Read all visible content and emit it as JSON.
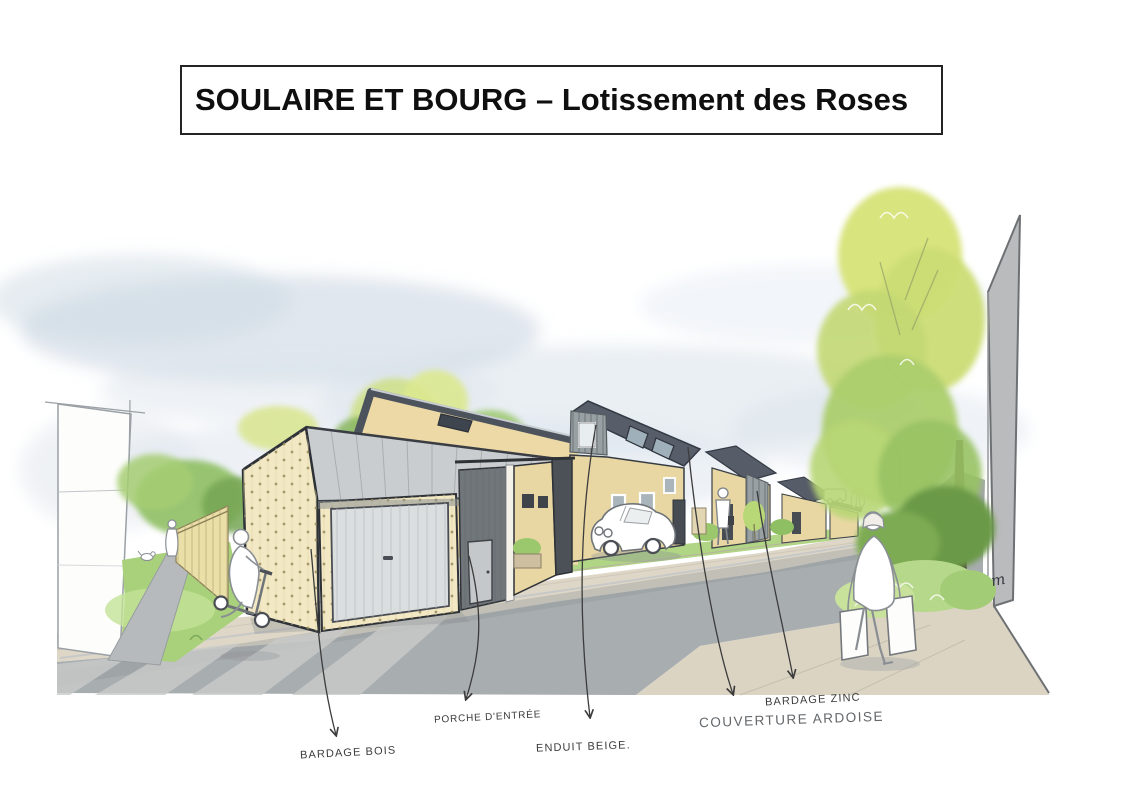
{
  "title": "SOULAIRE ET BOURG – Lotissement des Roses",
  "annotations": {
    "bardage_bois": "BARDAGE BOIS",
    "porche_entree": "PORCHE D'ENTRÉE",
    "enduit_beige": "ENDUIT BEIGE.",
    "couverture_ardoise": "COUVERTURE ARDOISE",
    "bardage_zinc": "BARDAGE ZINC"
  },
  "signature": "m",
  "colors": {
    "facade_cream": "#f2e8c2",
    "facade_beige": "#ecd9a6",
    "roof_slate": "#575d69",
    "zinc_gray": "#99a0a3",
    "garage_roof": "#c9cdcf",
    "garage_door": "#dbdedf",
    "road_gray": "#a8adb0",
    "sidewalk_beige": "#ded7c7",
    "grass_green": "#abd37f",
    "tree_light": "#d7e37c",
    "tree_dark": "#6b9a47",
    "sky_blue": "#ccd8e3",
    "wall_gray": "#babbbd",
    "outline_dark": "#33383f",
    "leader_line": "#3c3c3c"
  }
}
